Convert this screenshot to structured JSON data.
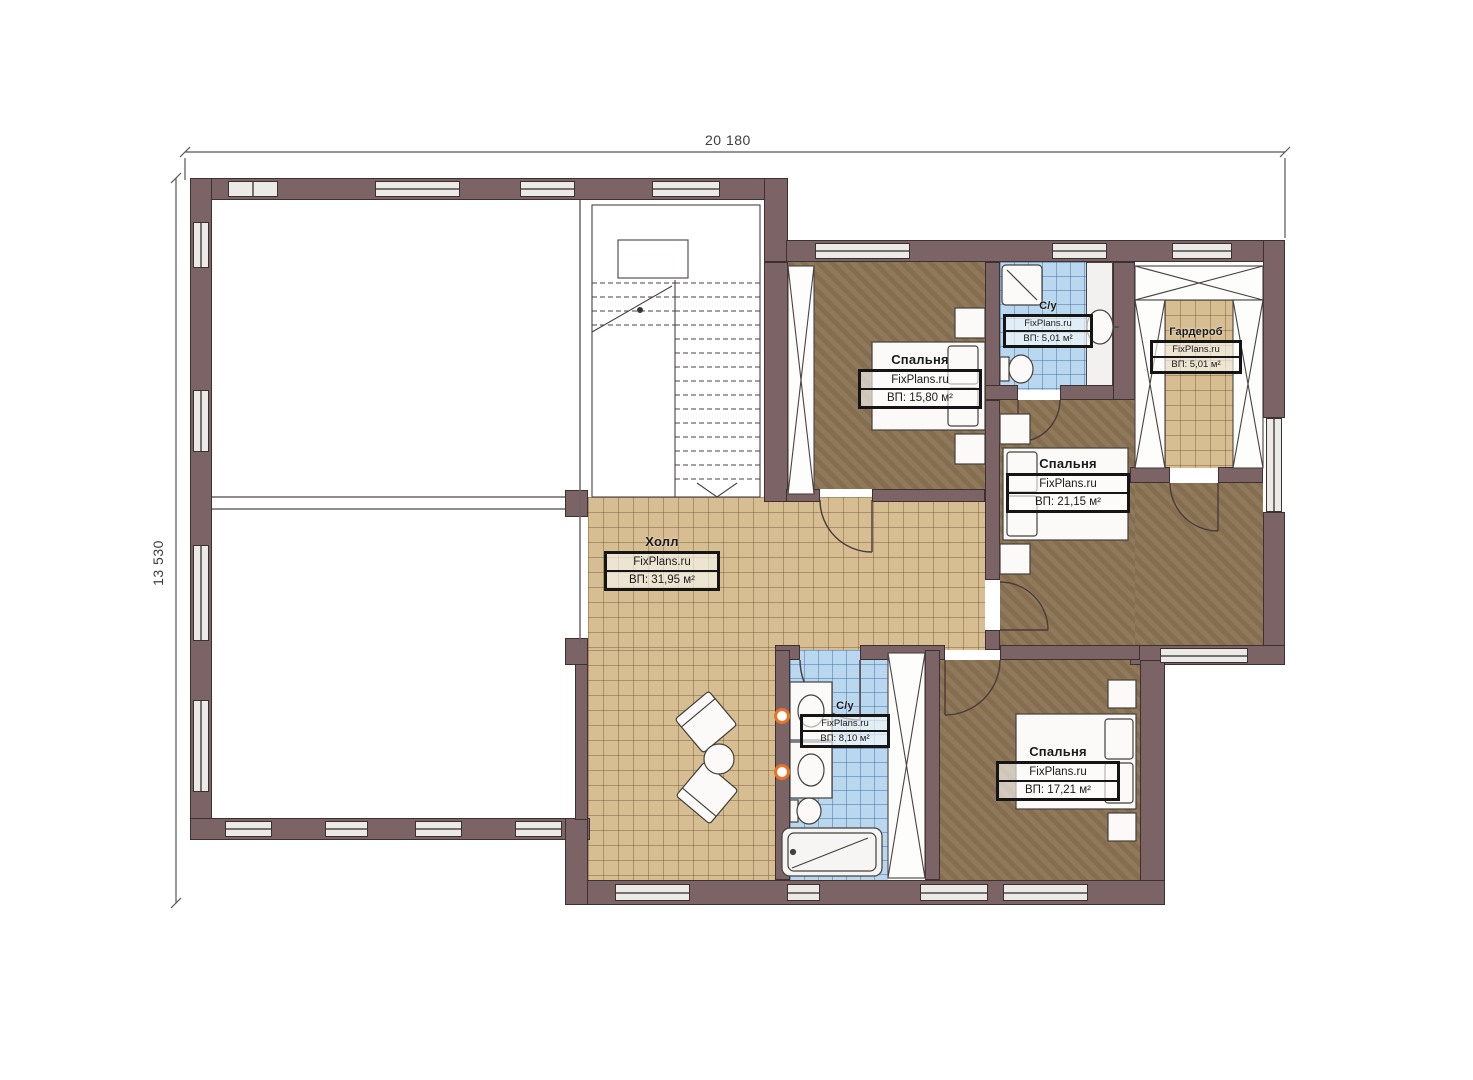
{
  "dimensions": {
    "top": "20 180",
    "left": "13 530"
  },
  "rooms": [
    {
      "id": "bedroom-top",
      "name": "Спальня",
      "watermark": "FixPlans.ru",
      "area": "ВП: 15,80 м²"
    },
    {
      "id": "bathroom-top",
      "name": "С/у",
      "watermark": "FixPlans.ru",
      "area": "ВП: 5,01 м²"
    },
    {
      "id": "wardrobe",
      "name": "Гардероб",
      "watermark": "FixPlans.ru",
      "area": "ВП: 5,01 м²"
    },
    {
      "id": "bedroom-right",
      "name": "Спальня",
      "watermark": "FixPlans.ru",
      "area": "ВП: 21,15 м²"
    },
    {
      "id": "hall",
      "name": "Холл",
      "watermark": "FixPlans.ru",
      "area": "ВП: 31,95 м²"
    },
    {
      "id": "bathroom-bottom",
      "name": "С/у",
      "watermark": "FixPlans.ru",
      "area": "ВП: 8,10 м²"
    },
    {
      "id": "bedroom-bottom",
      "name": "Спальня",
      "watermark": "FixPlans.ru",
      "area": "ВП: 17,21 м²"
    }
  ],
  "colors": {
    "wall": "#7c6466",
    "window": "#eceae7",
    "wood_floor": "#8c7453",
    "beige_tile": "#d7bd92",
    "blue_tile": "#b9d8f0",
    "accent_orange": "#e87427"
  }
}
